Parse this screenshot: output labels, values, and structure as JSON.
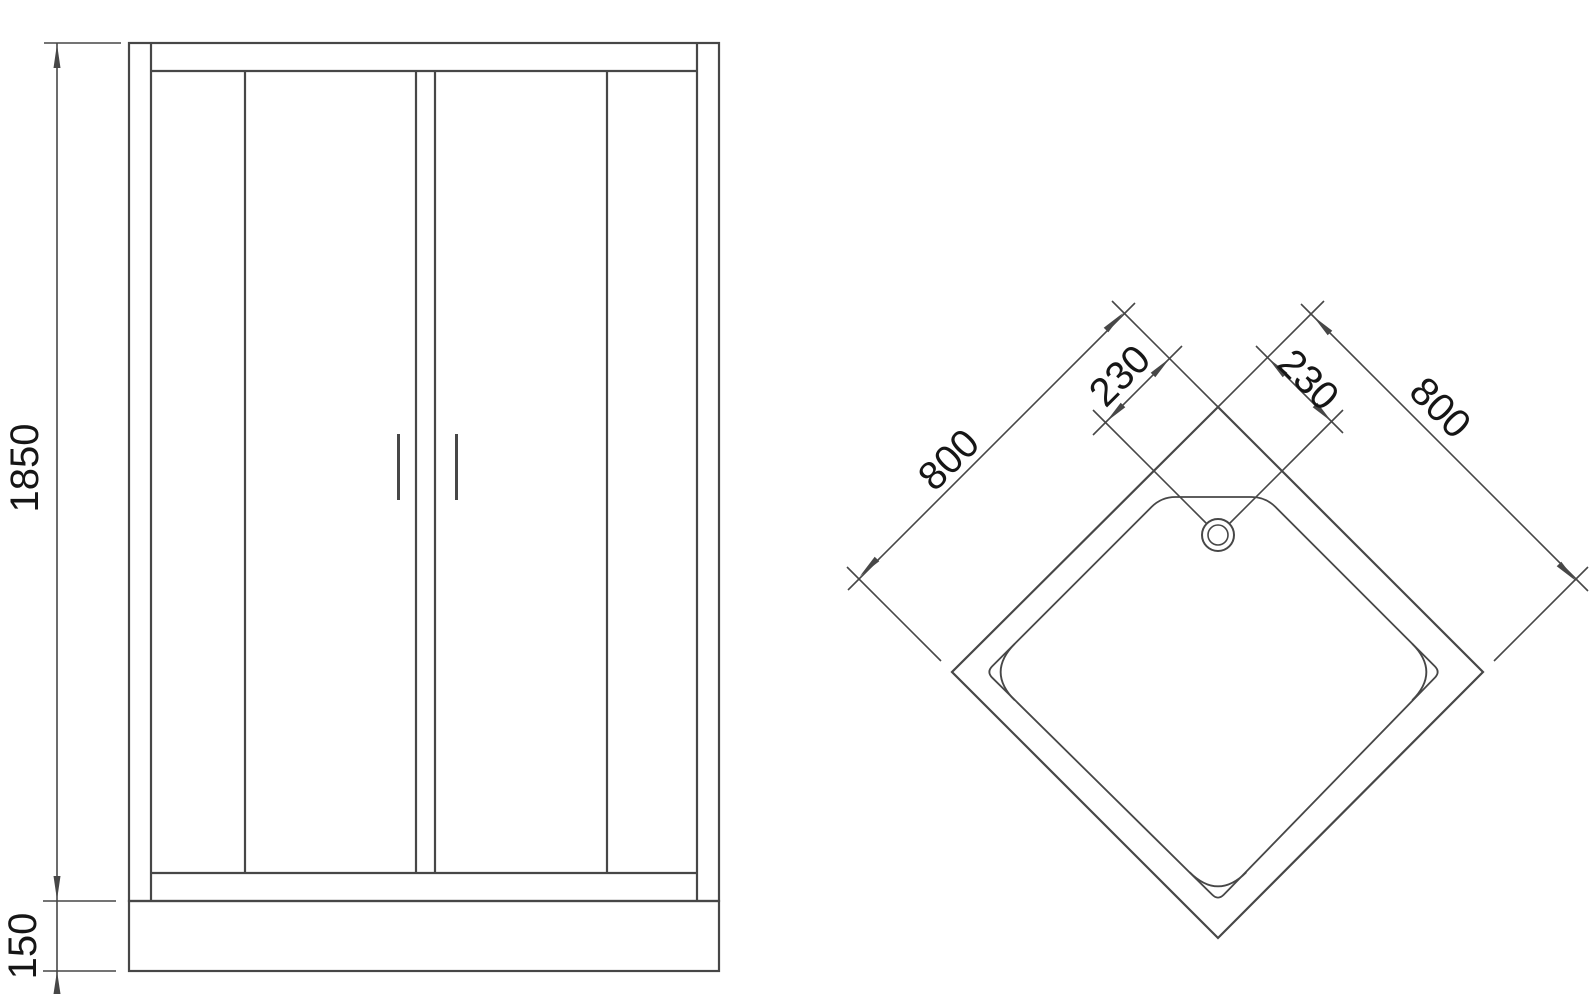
{
  "colors": {
    "line": "#474747",
    "text": "#161616",
    "background": "#ffffff"
  },
  "front_view": {
    "height_dim": "1850",
    "base_height_dim": "150"
  },
  "plan_view": {
    "left_edge_dim": "800",
    "right_edge_dim": "800",
    "left_drain_offset_dim": "230",
    "right_drain_offset_dim": "230"
  }
}
